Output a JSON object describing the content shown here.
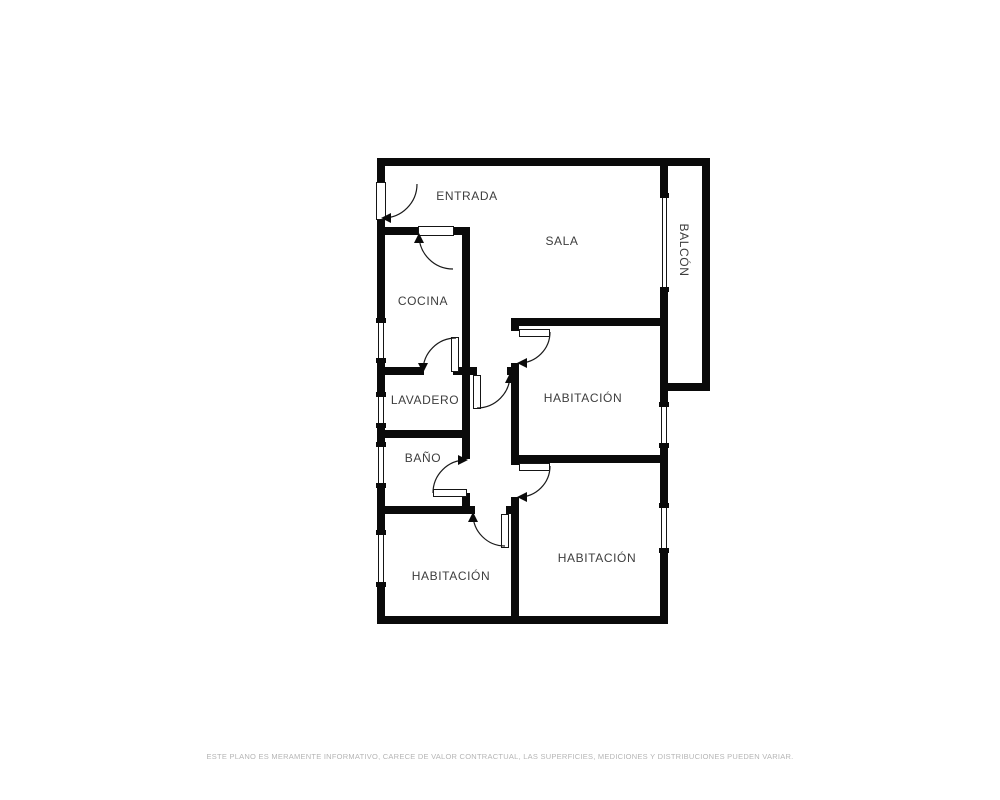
{
  "rooms": {
    "entrada": "ENTRADA",
    "sala": "SALA",
    "balcon": "BALCÓN",
    "cocina": "COCINA",
    "lavadero": "LAVADERO",
    "bano": "BAÑO",
    "habitacion1": "HABITACIÓN",
    "habitacion2": "HABITACIÓN",
    "habitacion3": "HABITACIÓN"
  },
  "footer": {
    "disclaimer": "ESTE PLANO ES MERAMENTE INFORMATIVO, CARECE DE VALOR CONTRACTUAL, LAS SUPERFICIES, MEDICIONES Y DISTRIBUCIONES PUEDEN VARIAR."
  },
  "colors": {
    "wall": "#0a0a0a",
    "label": "#3d3d3d",
    "disclaimer": "#b5b5b5",
    "background": "#ffffff"
  }
}
